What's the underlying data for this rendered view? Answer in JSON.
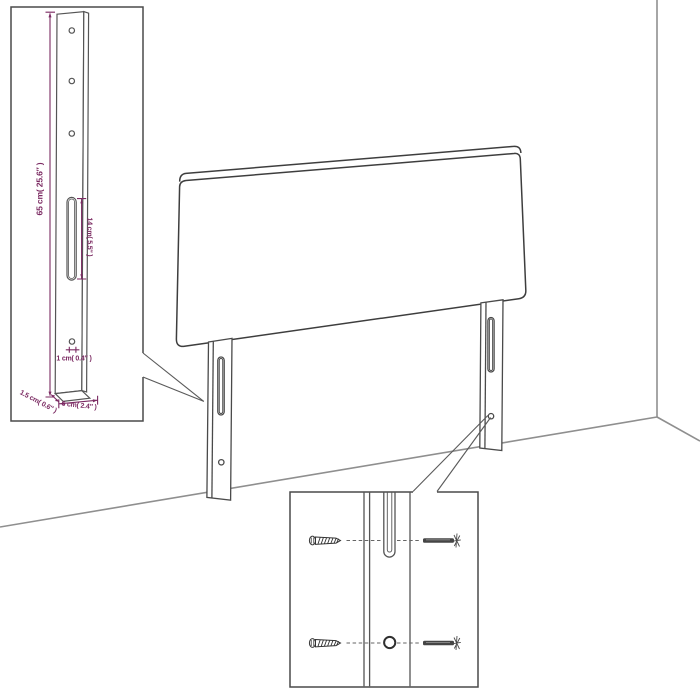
{
  "figure": {
    "type": "furniture-assembly-diagram",
    "subject": "upholstered headboard with two mounting legs shown against a wall corner",
    "insets": {
      "leg_detail": "enlarged upright mounting leg with holes, slot and dimensions",
      "fixing_detail": "close-up of leg slot and bottom hole with screws alignment"
    }
  },
  "dimensions": {
    "leg_height": "65 cm( 25.6″ )",
    "slot_length": "14 cm( 5.5″ )",
    "hole_diameter": "1 cm( 0.4″ )",
    "leg_thickness": "1.5 cm( 0.6″ )",
    "leg_width": "6 cm( 2.4″ )"
  },
  "icons": {
    "coarse_screw": "screw-icon",
    "machine_screw": "bolt-icon"
  },
  "colors": {
    "dimension_accent": "#7B2A62",
    "outline": "#4A4A4A",
    "wall_line": "#8F8F8F",
    "background": "#FFFFFF"
  }
}
